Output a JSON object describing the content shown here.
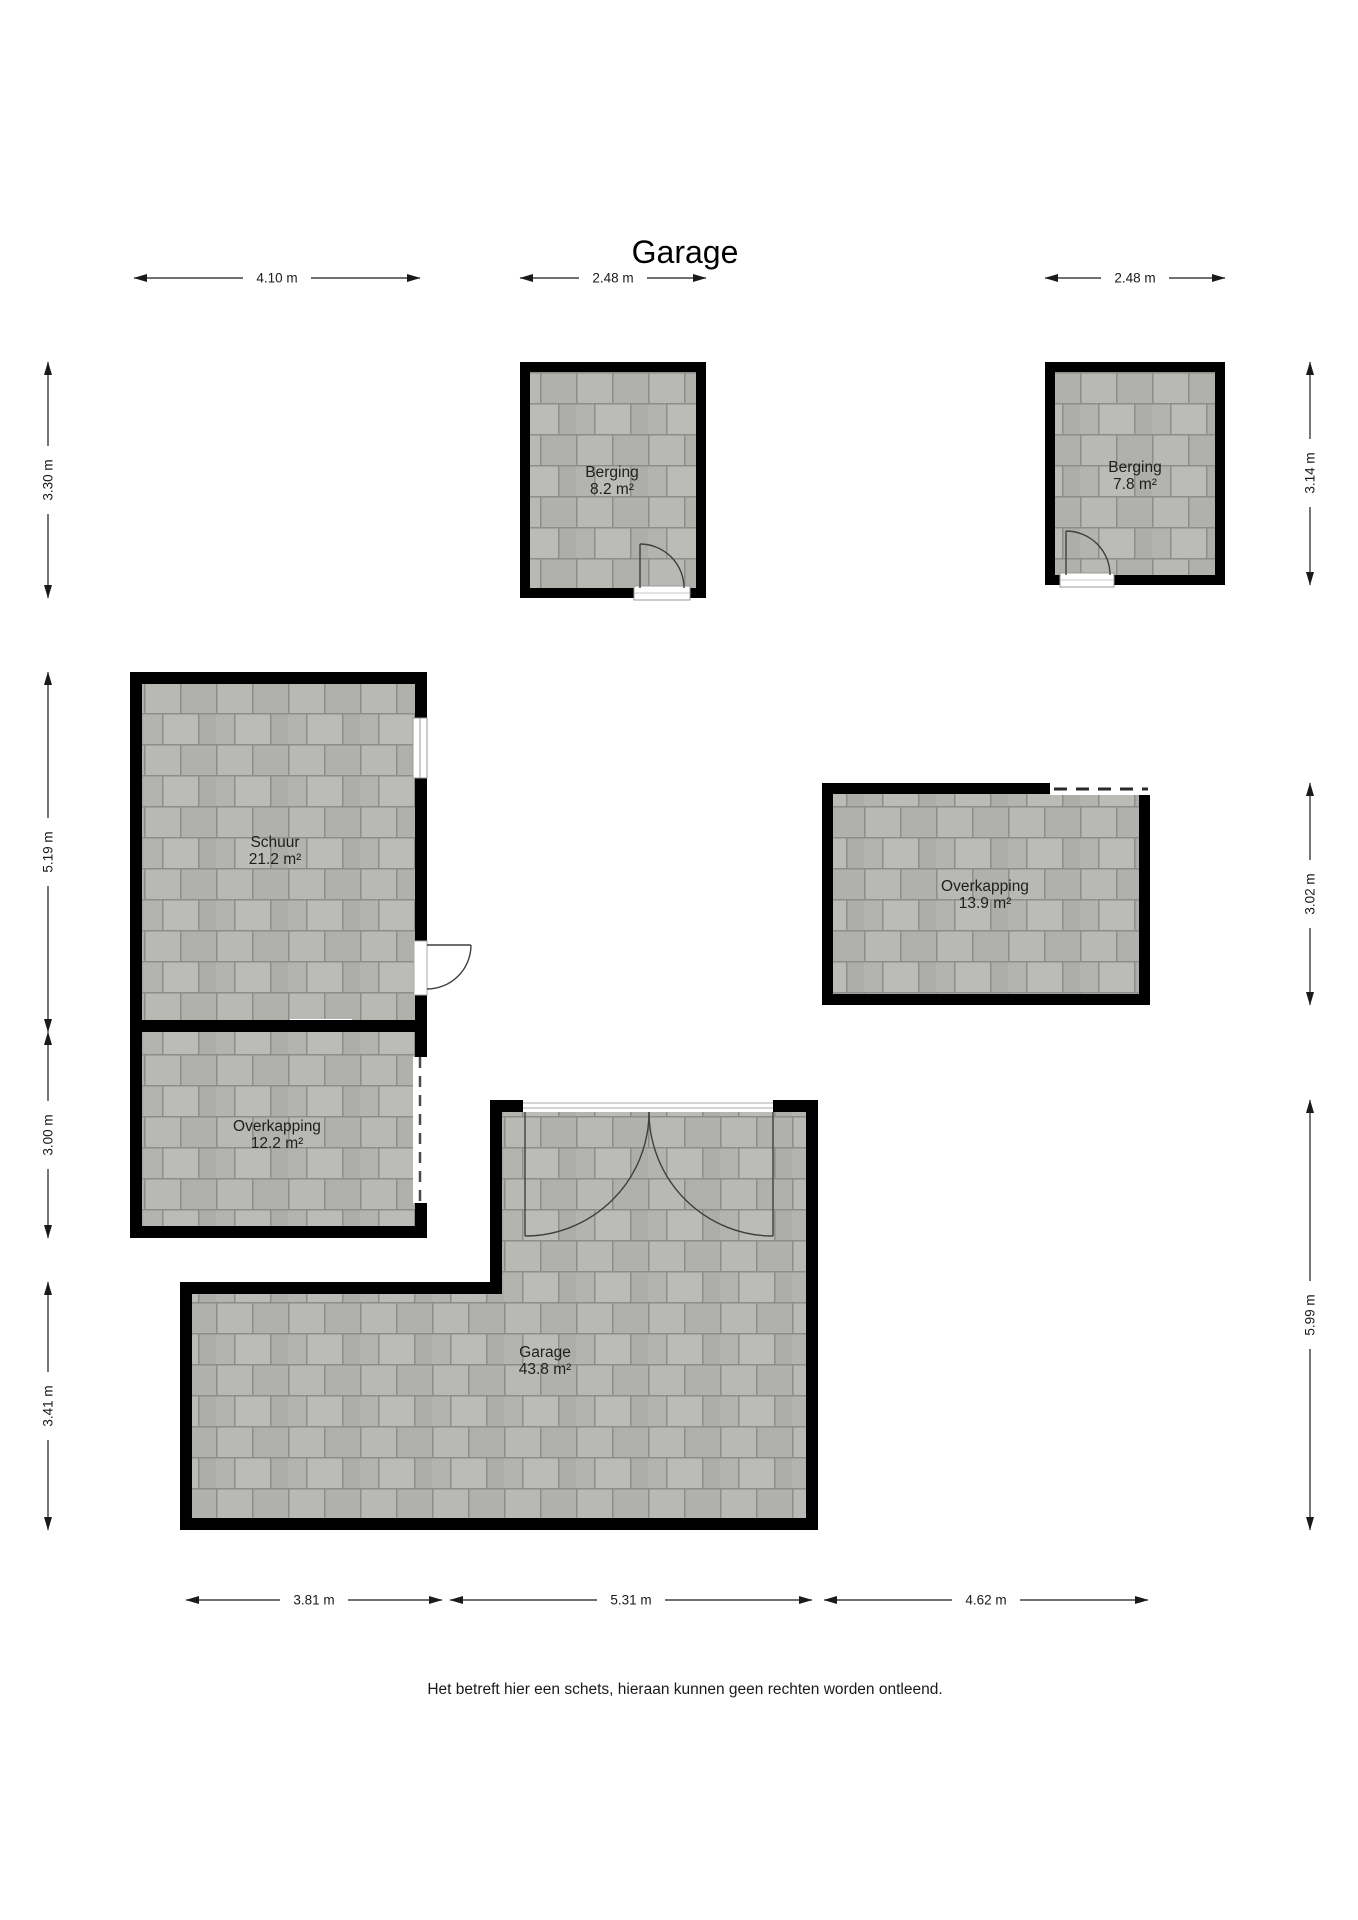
{
  "title": "Garage",
  "footer": "Het betreft hier een schets, hieraan kunnen geen rechten worden ontleend.",
  "rooms": {
    "berging1": {
      "name": "Berging",
      "area": "8.2 m²"
    },
    "berging2": {
      "name": "Berging",
      "area": "7.8 m²"
    },
    "schuur": {
      "name": "Schuur",
      "area": "21.2 m²"
    },
    "overkapping13": {
      "name": "Overkapping",
      "area": "13.9 m²"
    },
    "overkapping12": {
      "name": "Overkapping",
      "area": "12.2 m²"
    },
    "garage": {
      "name": "Garage",
      "area": "43.8 m²"
    }
  },
  "dimensions": {
    "top": [
      "4.10 m",
      "2.48 m",
      "2.48 m"
    ],
    "left": [
      "3.30 m",
      "5.19 m",
      "3.00 m",
      "3.41 m"
    ],
    "right": [
      "3.14 m",
      "3.02 m",
      "5.99 m"
    ],
    "bottom": [
      "3.81 m",
      "5.31 m",
      "4.62 m"
    ]
  },
  "colors": {
    "wall": "#000000",
    "floor_tile": "#b4b4b1",
    "floor_gap": "#8d8d89",
    "background": "#ffffff",
    "dimension": "#1a1a1a"
  }
}
